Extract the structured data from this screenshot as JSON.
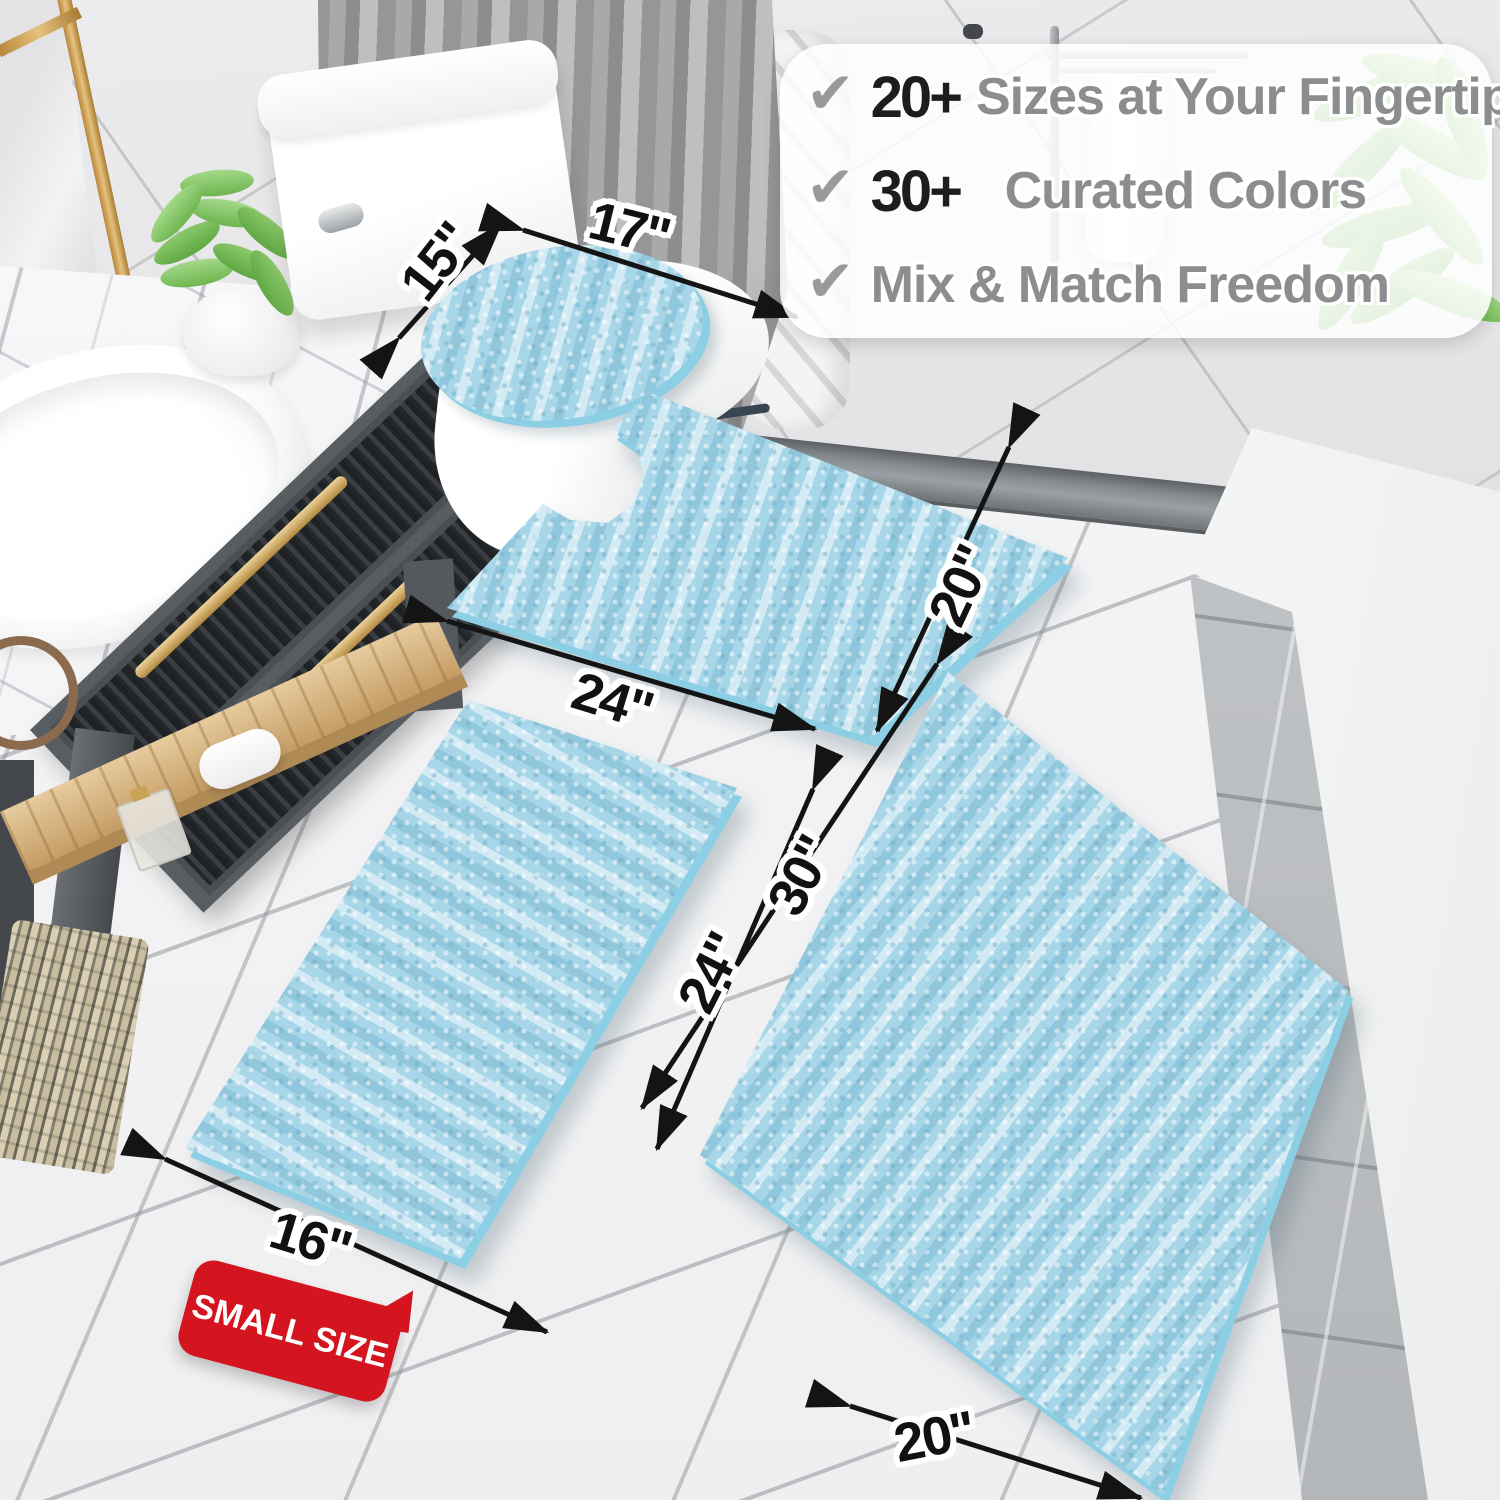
{
  "meta": {
    "description": "Product marketing photo of a light-blue chenille bathroom rug set shown in a bathroom with size annotations"
  },
  "features": {
    "check_glyph": "✔",
    "items": [
      {
        "stat": "20+",
        "label": "Sizes at Your Fingertips"
      },
      {
        "stat": "30+",
        "label": "Curated Colors"
      },
      {
        "stat": "",
        "label": "Mix & Match Freedom"
      }
    ],
    "stat_color": "#1d1d1f",
    "label_color": "#8b8d8f",
    "check_color": "#9a9a9a"
  },
  "badge": {
    "label": "SMALL SIZE",
    "bg_color": "#d4141e",
    "text_color": "#ffffff"
  },
  "dim_labels": [
    {
      "id": "lid-width",
      "text": "15\""
    },
    {
      "id": "lid-length",
      "text": "17\""
    },
    {
      "id": "contour-width",
      "text": "24\""
    },
    {
      "id": "contour-depth",
      "text": "20\""
    },
    {
      "id": "large-length",
      "text": "30\""
    },
    {
      "id": "small-length",
      "text": "24\""
    },
    {
      "id": "small-width",
      "text": "16\""
    },
    {
      "id": "large-width",
      "text": "20\""
    }
  ],
  "products": [
    {
      "name": "toilet-lid-cover",
      "size": "15\" x 17\""
    },
    {
      "name": "contour-rug",
      "size": "20\" x 24\""
    },
    {
      "name": "small-bath-rug",
      "size": "16\" x 24\""
    },
    {
      "name": "large-bath-rug",
      "size": "20\" x 30\""
    }
  ],
  "colors": {
    "rug_blue": "#a6d6e8",
    "rug_backing": "#8ccfe4",
    "badge_red": "#d4141e",
    "arrow_black": "#141414",
    "gold_hardware": "#c9a257",
    "wall_tile": "#e9e9eb",
    "floor_tile": "#f5f5f6"
  }
}
